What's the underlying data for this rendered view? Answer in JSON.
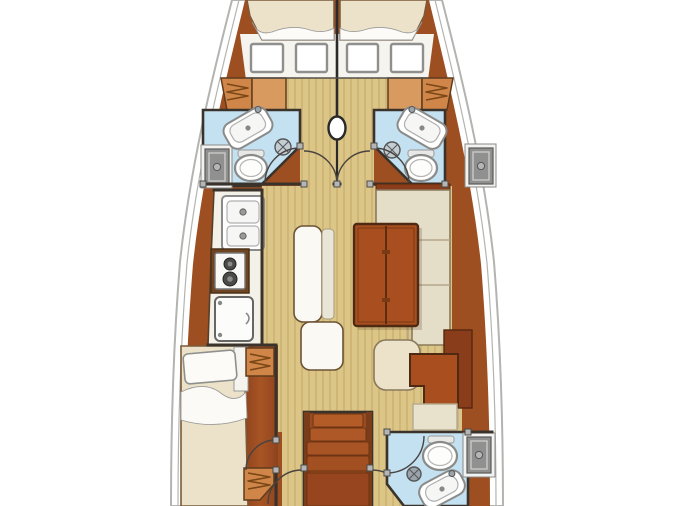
{
  "canvas": {
    "width": 675,
    "height": 506,
    "background": "#ffffff"
  },
  "colors": {
    "hull_outline": "#b3b3b0",
    "hull_wood": "#9d4f22",
    "hull_wood_dark": "#7e3c17",
    "deck_white": "#f6f4ee",
    "floor_tan": "#dcc687",
    "floor_stripe": "#c9ad6c",
    "head_floor_blue": "#c3e1f1",
    "cushion_cream": "#ece1c9",
    "sheet_white": "#fcfbf8",
    "settee_beige": "#e4ddc7",
    "bench_white": "#fbf9f3",
    "table_wood": "#a84e1f",
    "stairs_wood": "#9a4c20",
    "locker_orange": "#d08648",
    "shower_gray": "#909090",
    "wall_dark": "#3a332c",
    "fixture_outline": "#8a8a88"
  },
  "floorplan": {
    "subject": "sailing-yacht interior accommodation plan",
    "orientation": "bow-at-top",
    "rooms": [
      {
        "id": "forward-cabin-left",
        "fixtures": [
          "v-berth",
          "deck-hatches",
          "hanging-locker"
        ]
      },
      {
        "id": "forward-cabin-right",
        "fixtures": [
          "v-berth",
          "deck-hatches",
          "hanging-locker"
        ]
      },
      {
        "id": "forward-head-left",
        "fixtures": [
          "sink",
          "toilet",
          "shower-tray",
          "shower-head"
        ]
      },
      {
        "id": "forward-head-right",
        "fixtures": [
          "sink",
          "toilet",
          "shower-tray",
          "shower-head"
        ]
      },
      {
        "id": "galley",
        "fixtures": [
          "double-sink",
          "two-burner-stove",
          "refrigerator"
        ]
      },
      {
        "id": "salon",
        "fixtures": [
          "folding-table",
          "bench-seats",
          "l-shaped-settee"
        ]
      },
      {
        "id": "nav-station",
        "fixtures": [
          "chart-table",
          "seat"
        ]
      },
      {
        "id": "aft-cabin-left",
        "fixtures": [
          "double-berth",
          "hanging-lockers"
        ]
      },
      {
        "id": "companionway",
        "fixtures": [
          "stairs"
        ]
      },
      {
        "id": "aft-head-right",
        "fixtures": [
          "toilet",
          "sink",
          "shower-tray",
          "shower-head"
        ]
      }
    ],
    "symbols": [
      "mast-symbol",
      "door-swing-arcs",
      "hinge-blocks"
    ]
  }
}
